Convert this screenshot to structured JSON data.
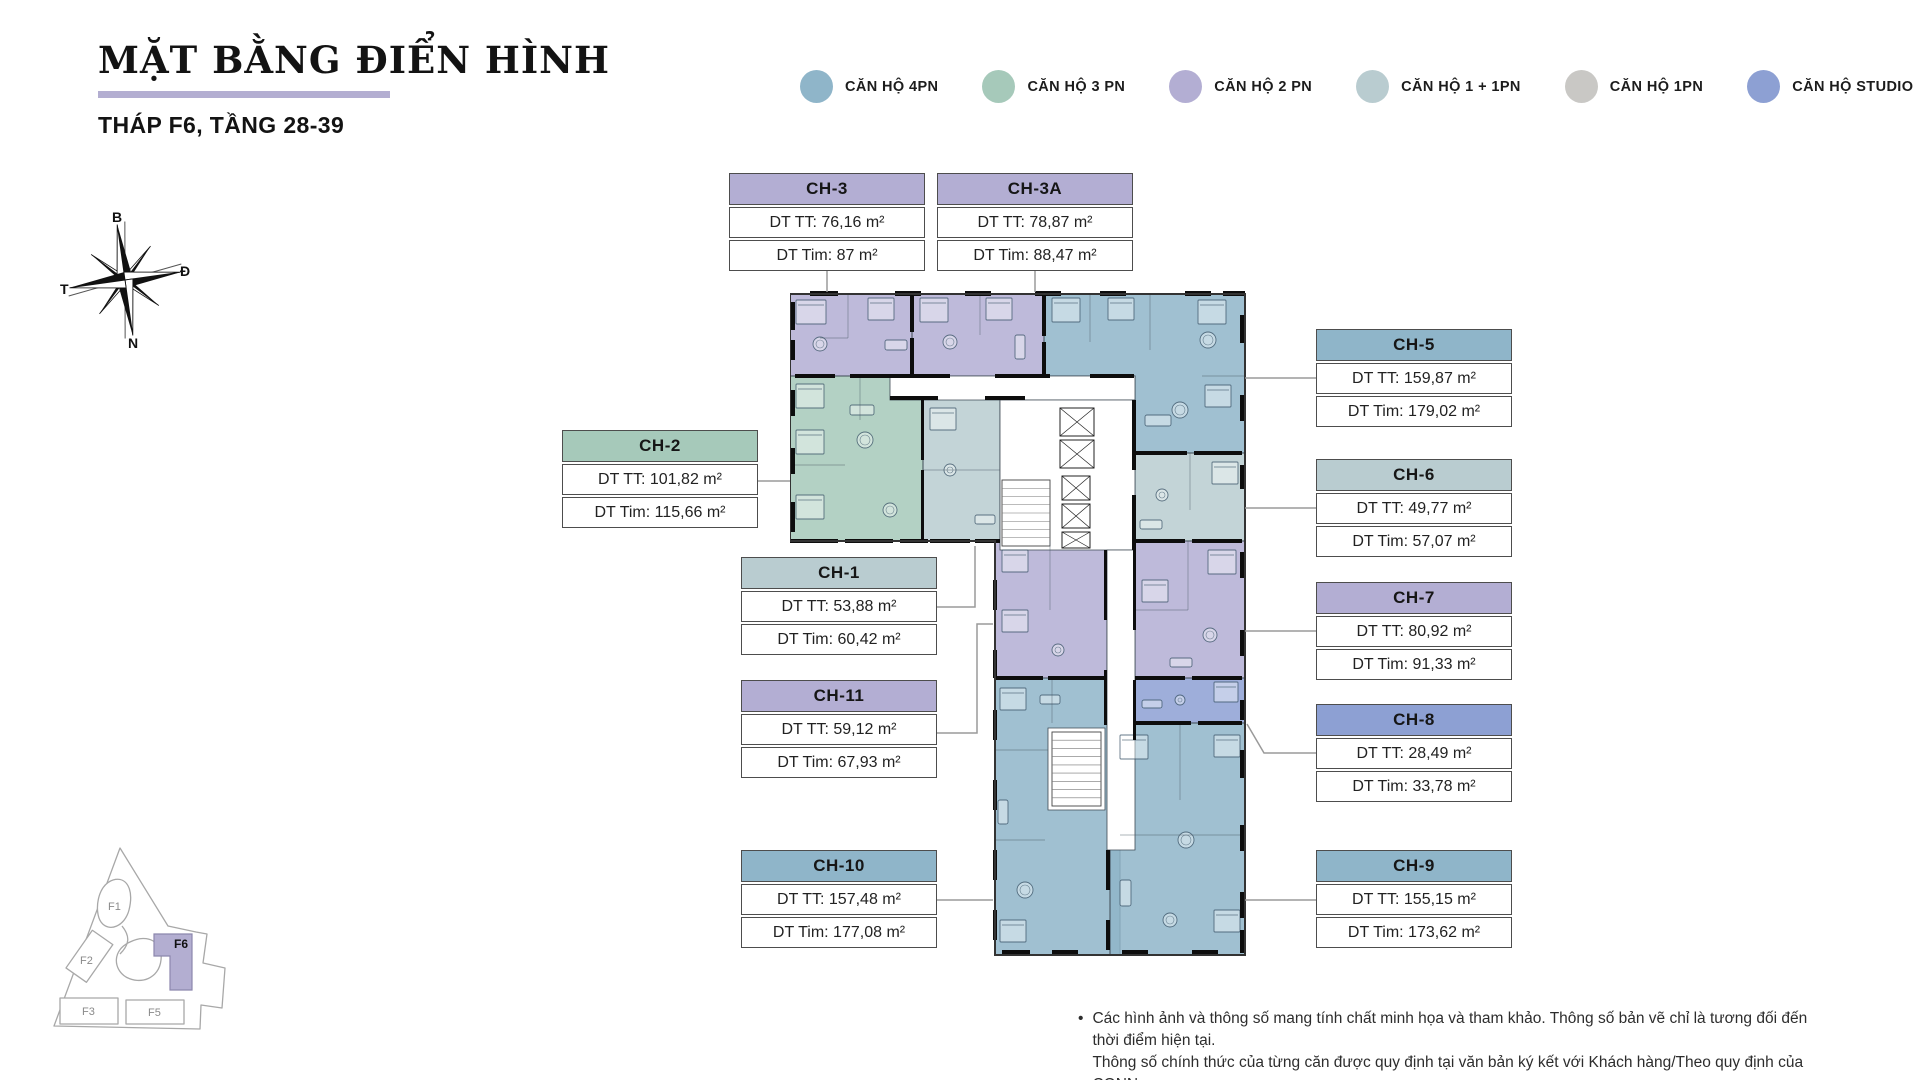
{
  "header": {
    "title": "MẶT BẰNG ĐIỂN HÌNH",
    "subtitle": "THÁP F6, TẦNG 28-39"
  },
  "colors": {
    "pn4": "#8FB5C9",
    "pn3": "#A6C9BA",
    "pn2": "#B3AED3",
    "pn1_1": "#B9CCD0",
    "pn1": "#C9C8C5",
    "studio": "#8DA0D3",
    "accent": "#B3AED1",
    "wall": "#0D0D0D",
    "connector": "#9A9A9A"
  },
  "legend": {
    "items": [
      {
        "key": "pn4",
        "label": "CĂN HỘ 4PN",
        "color": "#8FB5C9"
      },
      {
        "key": "pn3",
        "label": "CĂN HỘ 3 PN",
        "color": "#A6C9BA"
      },
      {
        "key": "pn2",
        "label": "CĂN HỘ 2 PN",
        "color": "#B3AED3"
      },
      {
        "key": "pn1_1",
        "label": "CĂN HỘ 1 + 1PN",
        "color": "#B9CCD0"
      },
      {
        "key": "pn1",
        "label": "CĂN HỘ 1PN",
        "color": "#C9C8C5"
      },
      {
        "key": "studio",
        "label": "CĂN HỘ STUDIO",
        "color": "#8DA0D3"
      }
    ]
  },
  "compass": {
    "north": "B",
    "east": "Đ",
    "south": "N",
    "west": "T"
  },
  "units": [
    {
      "id": "CH-3",
      "type": "pn2",
      "color": "#B3AED3",
      "dt_tt": "DT TT: 76,16 m²",
      "dt_tim": "DT Tim: 87 m²"
    },
    {
      "id": "CH-3A",
      "type": "pn2",
      "color": "#B3AED3",
      "dt_tt": "DT TT: 78,87 m²",
      "dt_tim": "DT Tim: 88,47 m²"
    },
    {
      "id": "CH-5",
      "type": "pn4",
      "color": "#8FB5C9",
      "dt_tt": "DT TT: 159,87 m²",
      "dt_tim": "DT Tim: 179,02 m²"
    },
    {
      "id": "CH-2",
      "type": "pn3",
      "color": "#A6C9BA",
      "dt_tt": "DT TT: 101,82 m²",
      "dt_tim": "DT Tim: 115,66 m²"
    },
    {
      "id": "CH-6",
      "type": "pn1_1",
      "color": "#B9CCD0",
      "dt_tt": "DT TT: 49,77 m²",
      "dt_tim": "DT Tim: 57,07 m²"
    },
    {
      "id": "CH-1",
      "type": "pn1_1",
      "color": "#B9CCD0",
      "dt_tt": "DT TT: 53,88 m²",
      "dt_tim": "DT Tim: 60,42 m²"
    },
    {
      "id": "CH-7",
      "type": "pn2",
      "color": "#B3AED3",
      "dt_tt": "DT TT: 80,92 m²",
      "dt_tim": "DT Tim: 91,33 m²"
    },
    {
      "id": "CH-11",
      "type": "pn2",
      "color": "#B3AED3",
      "dt_tt": "DT TT: 59,12 m²",
      "dt_tim": "DT Tim: 67,93 m²"
    },
    {
      "id": "CH-8",
      "type": "studio",
      "color": "#8DA0D3",
      "dt_tt": "DT TT: 28,49 m²",
      "dt_tim": "DT Tim: 33,78 m²"
    },
    {
      "id": "CH-10",
      "type": "pn4",
      "color": "#8FB5C9",
      "dt_tt": "DT TT: 157,48 m²",
      "dt_tim": "DT Tim: 177,08 m²"
    },
    {
      "id": "CH-9",
      "type": "pn4",
      "color": "#8FB5C9",
      "dt_tt": "DT TT: 155,15 m²",
      "dt_tim": "DT Tim: 173,62 m²"
    }
  ],
  "site_map": {
    "labels": [
      "F1",
      "F2",
      "F3",
      "F5"
    ],
    "highlight": "F6",
    "highlight_color": "#B3AED1"
  },
  "disclaimer": {
    "bullet": "•",
    "line1": "Các hình ảnh và thông số mang tính chất minh họa và tham khảo. Thông số bản vẽ chỉ là tương đối đến thời điểm hiện tại.",
    "line2": "Thông số chính thức của từng căn được quy định tại văn bản ký kết với Khách hàng/Theo quy định của CQNN"
  }
}
